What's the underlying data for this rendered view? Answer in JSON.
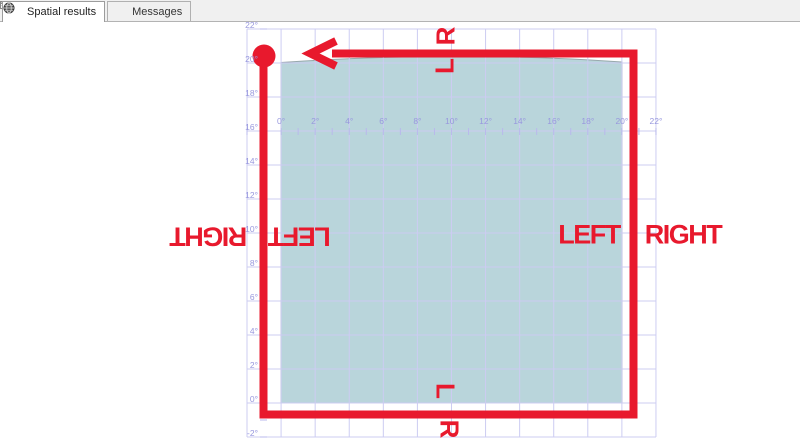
{
  "tabs": [
    {
      "label": "Spatial results",
      "icon": "globe-icon",
      "active": true
    },
    {
      "label": "Messages",
      "icon": "messages-icon",
      "active": false
    }
  ],
  "axis": {
    "x_labels": [
      "0°",
      "2°",
      "4°",
      "6°",
      "8°",
      "10°",
      "12°",
      "14°",
      "16°",
      "18°",
      "20°",
      "22°"
    ],
    "y_labels": [
      "22°",
      "20°",
      "18°",
      "16°",
      "14°",
      "12°",
      "10°",
      "8°",
      "6°",
      "4°",
      "2°",
      "0°",
      "-2°"
    ]
  },
  "annotations": {
    "left_edge_outer": "RIGHT",
    "left_edge_inner": "LEFT",
    "right_edge_inner": "LEFT",
    "right_edge_outer": "RIGHT",
    "top_edge_above": "R",
    "top_edge_below": "L",
    "bottom_edge_above": "L",
    "bottom_edge_below": "R"
  },
  "colors": {
    "annotation_red": "#e8192d",
    "grid_line": "#ccccf2",
    "axis_label_blue": "#9898de",
    "polygon_fill": "#b9d5db",
    "polygon_border": "#98a8ac",
    "tabbar_bg": "#f0f0f0"
  }
}
